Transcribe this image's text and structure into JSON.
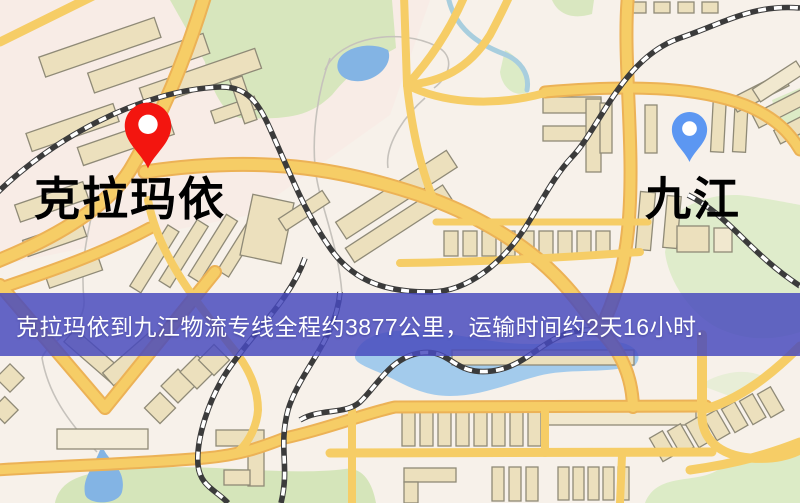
{
  "map": {
    "origin": {
      "label": "克拉玛依",
      "pin_color": "#f3150f",
      "label_color": "#e60d0d"
    },
    "destination": {
      "label": "九江",
      "pin_color": "#5c97f2",
      "label_color": "#2626d4"
    },
    "banner": {
      "text": "克拉玛依到九江物流专线全程约3877公里，运输时间约2天16小时.",
      "bg_color": "rgba(72,74,190,0.84)",
      "text_color": "#ffffff"
    },
    "route": {
      "distance": "约3877公里",
      "duration": "约2天16小时"
    }
  }
}
